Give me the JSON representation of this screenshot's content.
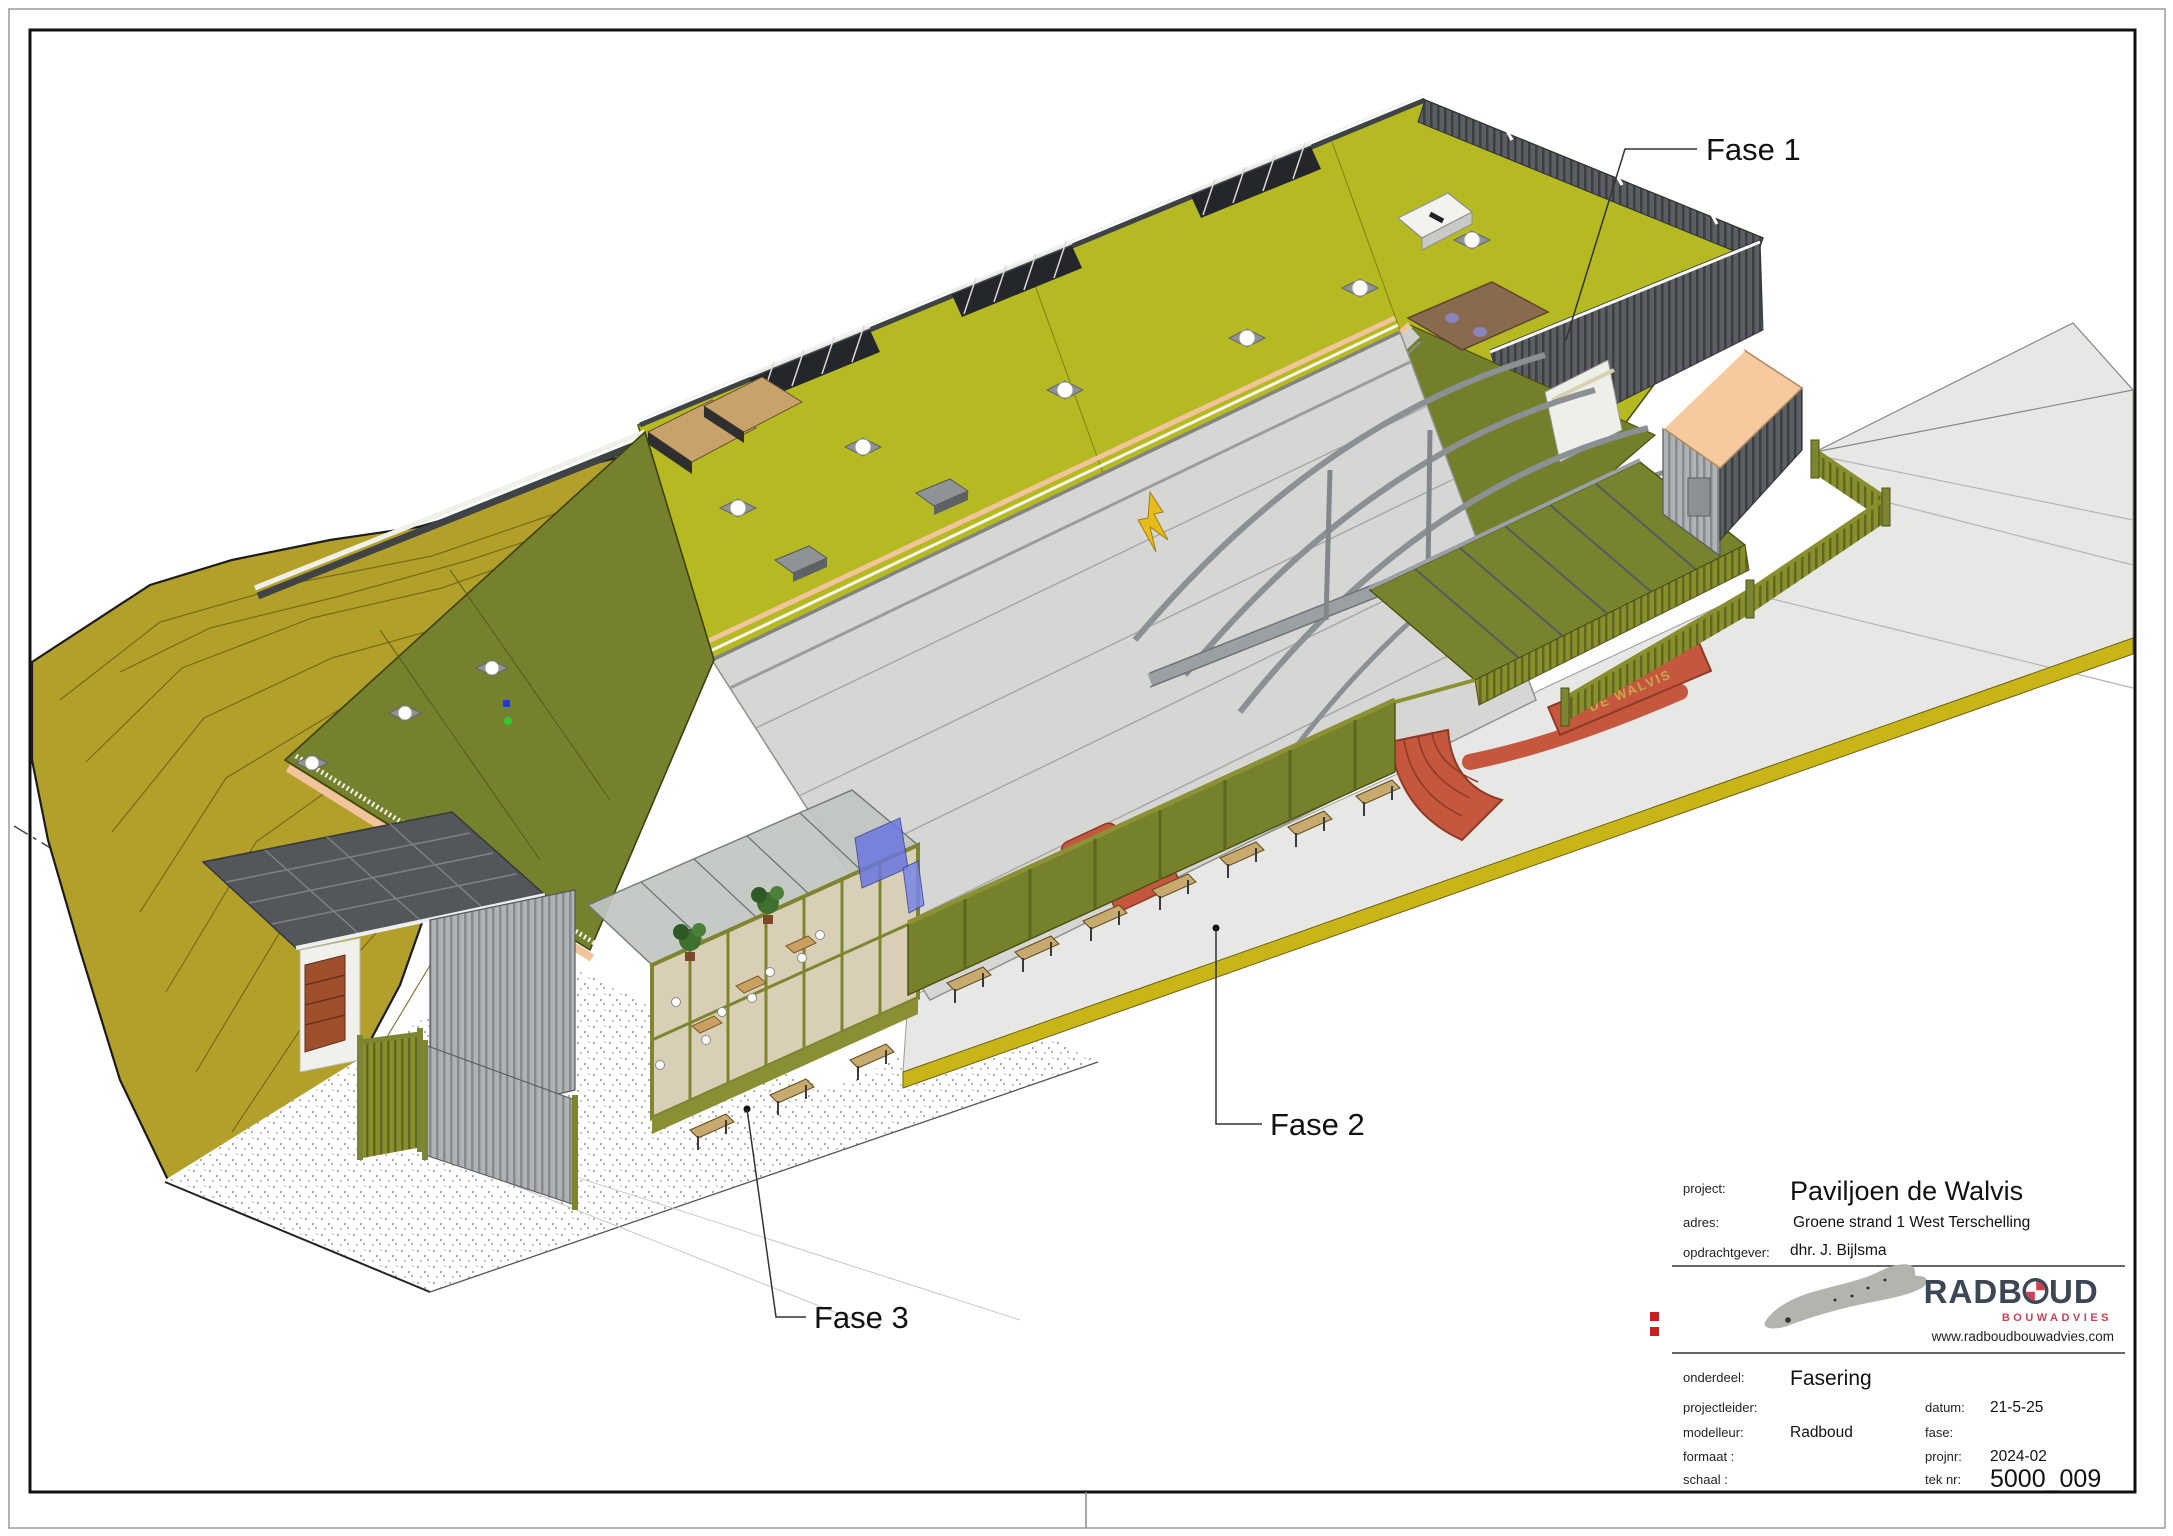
{
  "drawing": {
    "phase_labels": [
      {
        "label": "Fase 1"
      },
      {
        "label": "Fase 2"
      },
      {
        "label": "Fase 3"
      }
    ],
    "building_sign": "DE WALVIS",
    "colors": {
      "roof_green": "#b6ba22",
      "roof_olive": "#75812c",
      "dune": "#b3a02b",
      "canopy_gray": "#d6d7d4",
      "concrete": "#e7e7e5",
      "accent_red": "#c4573e",
      "fascia_peach": "#f2c49e",
      "logo_navy": "#3d4654",
      "logo_red": "#d04050",
      "registration_mark_red": "#cc1f1f"
    }
  },
  "title_block": {
    "project_label": "project:",
    "project": "Paviljoen de Walvis",
    "adres_label": "adres:",
    "adres": "Groene strand 1 West Terschelling",
    "opdrachtgever_label": "opdrachtgever:",
    "opdrachtgever": "dhr. J. Bijlsma",
    "onderdeel_label": "onderdeel:",
    "onderdeel": "Fasering",
    "projectleider_label": "projectleider:",
    "projectleider": "",
    "modelleur_label": "modelleur:",
    "modelleur": "Radboud",
    "formaat_label": "formaat :",
    "formaat": "",
    "schaal_label": "schaal :",
    "schaal": "",
    "datum_label": "datum:",
    "datum": "21-5-25",
    "fase_label": "fase:",
    "fase": "",
    "projnr_label": "projnr:",
    "projnr": "2024-02",
    "teknr_label": "tek nr:",
    "teknr": "5000_009",
    "logo": {
      "name_part1": "RADB",
      "name_part2": "UD",
      "subtitle": "BOUWADVIES",
      "url": "www.radboudbouwadvies.com"
    }
  }
}
